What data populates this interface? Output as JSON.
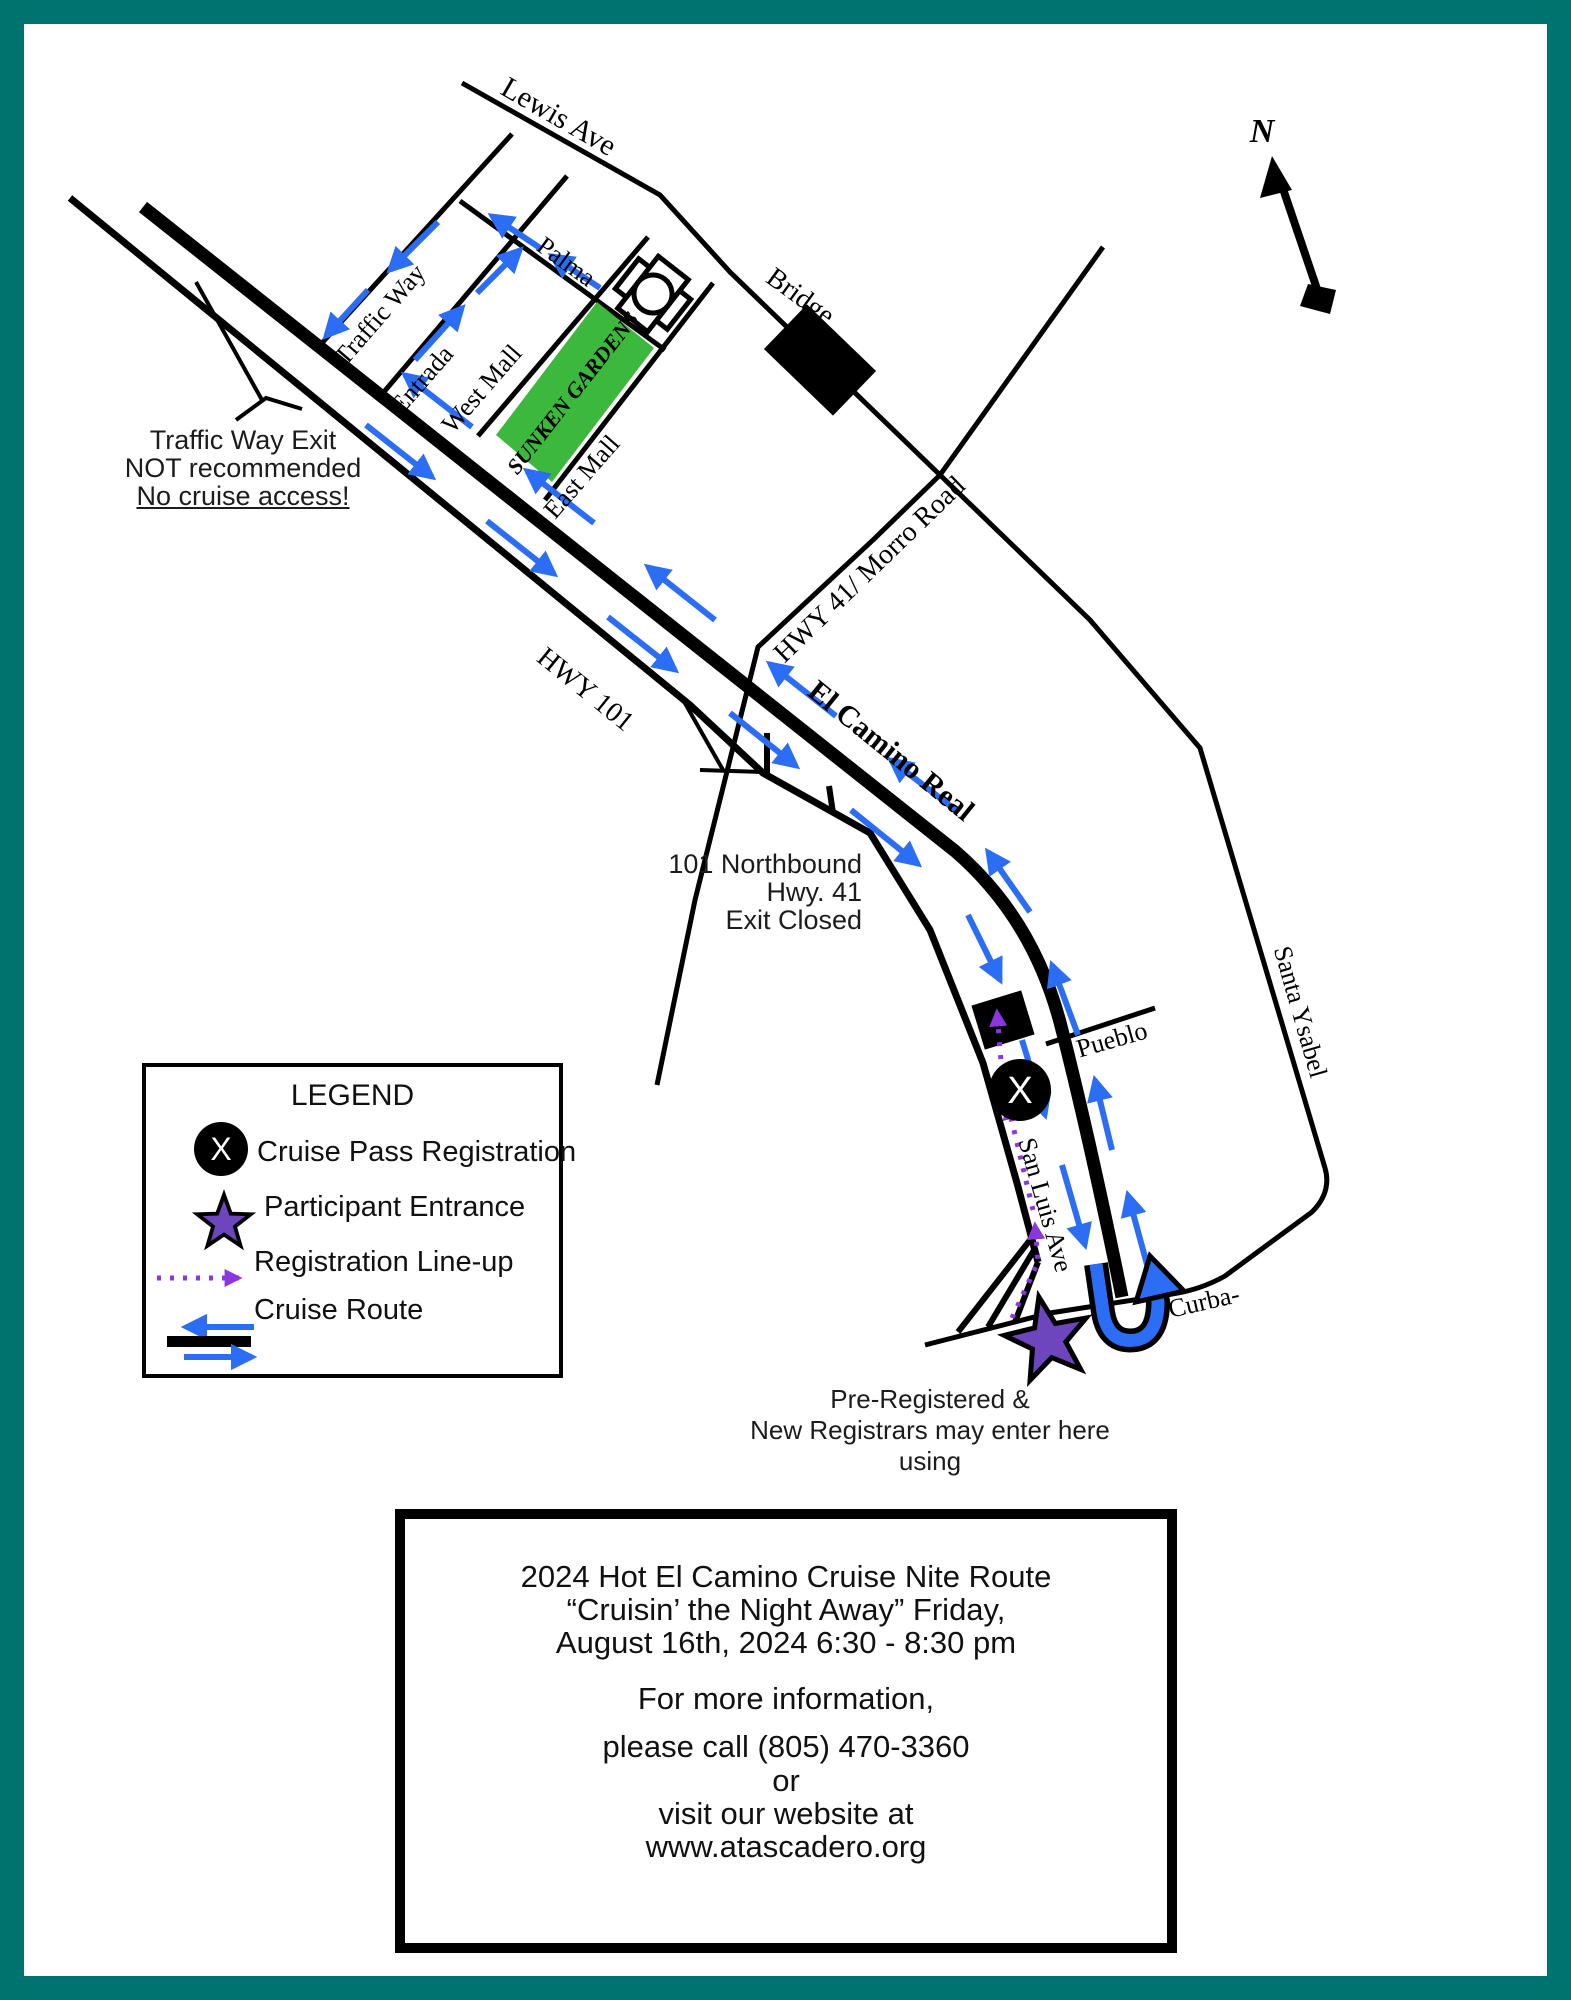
{
  "colors": {
    "teal": "#00736f",
    "green": "#3cb83c",
    "blue": "#2b6ef5",
    "violet": "#8c36e0",
    "star": "#6d46bd",
    "ink": "#000000",
    "paper": "#ffffff"
  },
  "compass": {
    "label": "N"
  },
  "symbols": {
    "registration_x": "X"
  },
  "streets": {
    "lewis": "Lewis Ave",
    "palma": "Palma",
    "traffic_way": "Traffic Way",
    "entrada": "Entrada",
    "west_mall": "West Mall",
    "east_mall": "East Mall",
    "sunken_gardens": "SUNKEN GARDENS",
    "bridge": "Bridge",
    "hwy41": "HWY 41/ Morro Road",
    "hwy101": "HWY 101",
    "el_camino": "El Camino Real",
    "pueblo": "Pueblo",
    "san_luis": "San Luis Ave",
    "santa_ysabel": "Santa Ysabel",
    "curbaril": "Curba-"
  },
  "notes": {
    "traffic_exit_lines": [
      "Traffic Way Exit",
      "NOT recommended",
      "No cruise access!"
    ],
    "exit_closed_lines": [
      "101 Northbound",
      "Hwy. 41",
      "Exit Closed"
    ],
    "entrance_lines": [
      "Pre-Registered &",
      "New Registrars may enter here",
      "using"
    ]
  },
  "legend": {
    "title": "LEGEND",
    "items": [
      {
        "label": "Cruise Pass Registration"
      },
      {
        "label": "Participant Entrance"
      },
      {
        "label": "Registration Line-up"
      },
      {
        "label": "Cruise Route"
      }
    ]
  },
  "info_box": {
    "title_lines": [
      "2024 Hot El Camino Cruise Nite Route",
      "“Cruisin’ the Night Away” Friday,",
      "August 16th, 2024 6:30 - 8:30 pm"
    ],
    "body_lines": [
      "For more information,",
      "please call (805) 470-3360",
      "or",
      "visit our website at",
      "www.atascadero.org"
    ]
  }
}
